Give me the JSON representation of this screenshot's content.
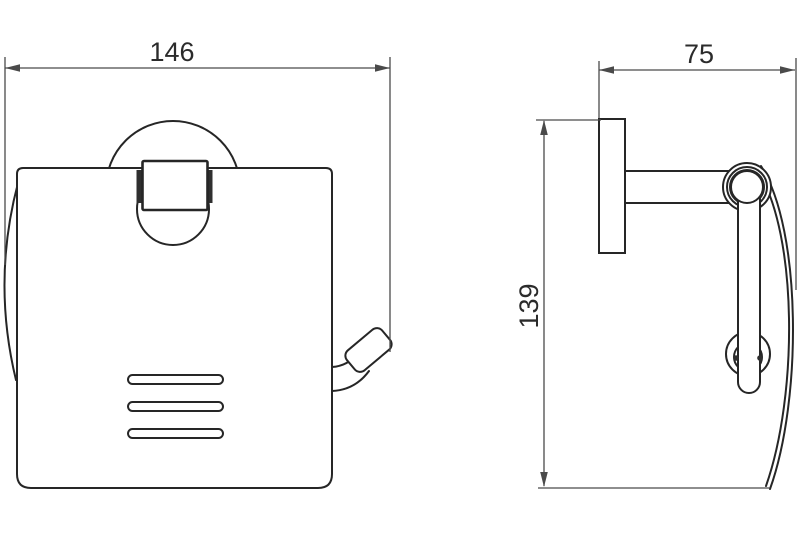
{
  "drawing": {
    "background": "#ffffff",
    "outline_color": "#262626",
    "dimension_color": "#4a4a4a",
    "hinge_fill": "#2f2f2f",
    "dimensions": {
      "front_width": "146",
      "side_depth": "75",
      "side_height": "139"
    }
  }
}
